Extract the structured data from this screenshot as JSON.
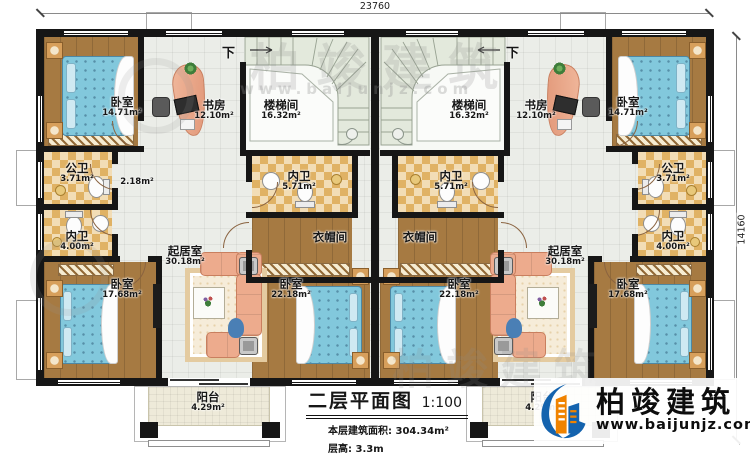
{
  "dimensions": {
    "width": "23760",
    "height": "14160"
  },
  "stairs": {
    "direction": "下"
  },
  "rooms": {
    "bedroom_top": {
      "name": "卧室",
      "area": "14.71m²"
    },
    "study": {
      "name": "书房",
      "area": "12.10m²"
    },
    "stairwell": {
      "name": "楼梯间",
      "area": "16.32m²"
    },
    "hall": {
      "area": "2.18m²"
    },
    "public_bath": {
      "name": "公卫",
      "area": "3.71m²"
    },
    "inner_bath": {
      "name": "内卫",
      "area": "4.00m²"
    },
    "center_bath": {
      "name": "内卫",
      "area": "5.71m²"
    },
    "cloakroom": {
      "name": "衣帽间"
    },
    "living": {
      "name": "起居室",
      "area": "30.18m²"
    },
    "bedroom_corner": {
      "name": "卧室",
      "area": "17.68m²"
    },
    "bedroom_mid": {
      "name": "卧室",
      "area": "22.18m²"
    },
    "balcony": {
      "name": "阳台",
      "area": "4.29m²"
    }
  },
  "title_block": {
    "title": "二层平面图",
    "scale": "1:100",
    "floor_area_label": "本层建筑面积:",
    "floor_area_value": "304.34m²",
    "floor_height_label": "层高:",
    "floor_height_value": "3.3m"
  },
  "logo": {
    "name": "柏竣建筑",
    "website": "www.baijunjz.com"
  },
  "watermark": {
    "brand": "柏竣建筑",
    "site": "www.baijunjz.com"
  }
}
